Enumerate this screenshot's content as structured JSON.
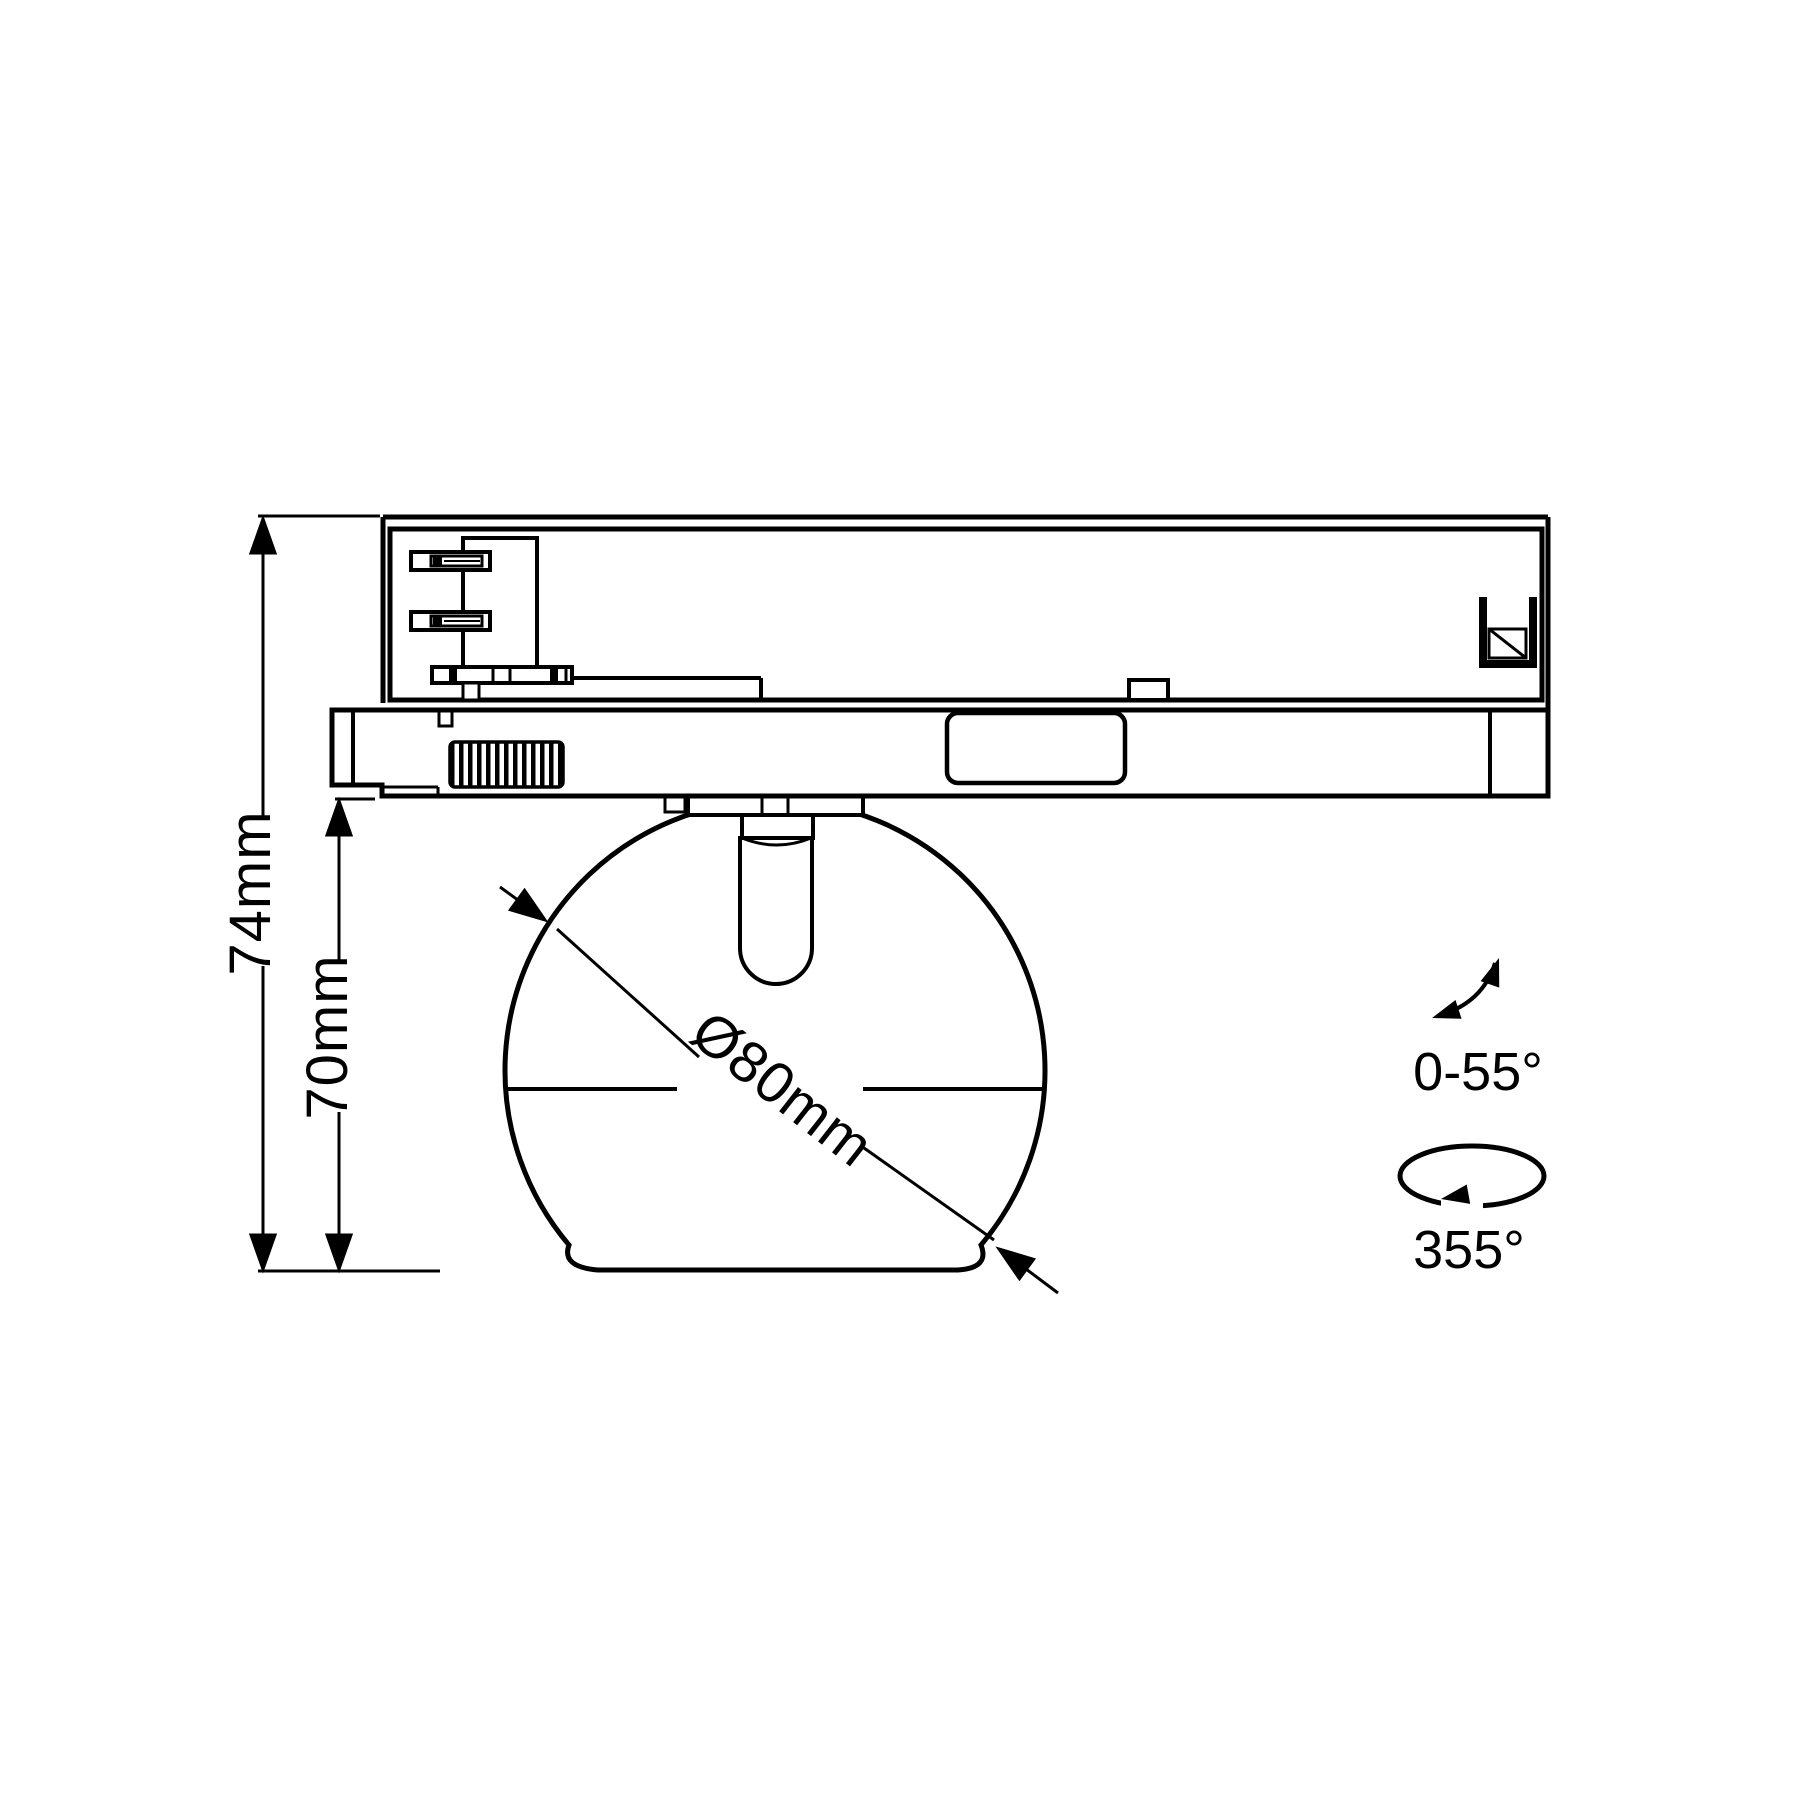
{
  "labels": {
    "overall_height": "74mm",
    "head_height": "70mm",
    "head_diameter": "Ø80mm",
    "tilt_range": "0-55°",
    "rotation_range": "355°"
  },
  "colors": {
    "line": "#000000",
    "background": "#ffffff"
  }
}
